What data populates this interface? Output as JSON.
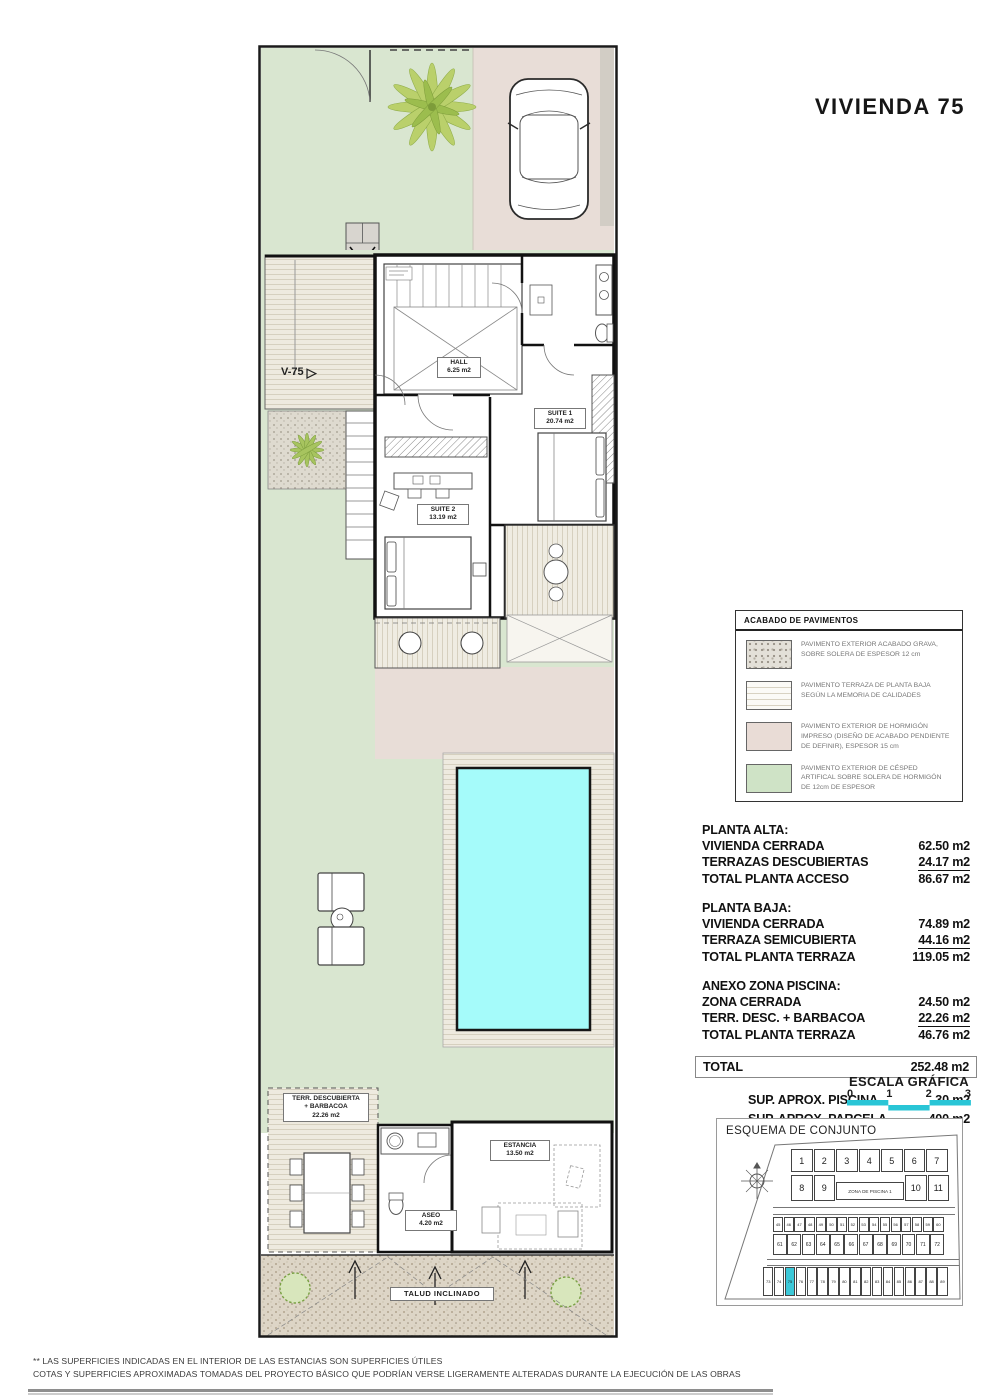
{
  "title": "VIVIENDA 75",
  "colors": {
    "lawn": "#d9e6d0",
    "driveway_concrete": "#e8ddd7",
    "pool_water": "#a5fbfa",
    "deck": "#eeeadf",
    "scale_bar_cyan": "#29c5d6",
    "highlight_unit_cyan": "#3cc8d8"
  },
  "plan": {
    "entry_label": "V-75",
    "labels": {
      "hall": {
        "name": "HALL",
        "area": "6.25 m2"
      },
      "suite1": {
        "name": "SUITE 1",
        "area": "20.74 m2"
      },
      "suite2": {
        "name": "SUITE 2",
        "area": "13.19 m2"
      },
      "estancia": {
        "name": "ESTANCIA",
        "area": "13.50 m2"
      },
      "aseo": {
        "name": "ASEO",
        "area": "4.20 m2"
      },
      "terraza": {
        "name": "TERR. DESCUBIERTA",
        "name2": "+ BARBACOA",
        "area": "22.26 m2"
      },
      "talud": {
        "name": "TALUD INCLINADO"
      }
    }
  },
  "legend": {
    "title": "ACABADO DE PAVIMENTOS",
    "items": [
      {
        "swatch": "gravel",
        "text": "PAVIMENTO EXTERIOR ACABADO GRAVA, SOBRE SOLERA DE ESPESOR 12 cm"
      },
      {
        "swatch": "terrace",
        "text": "PAVIMENTO TERRAZA DE PLANTA BAJA SEGÚN LA MEMORIA DE CALIDADES"
      },
      {
        "swatch": "concrete",
        "text": "PAVIMENTO EXTERIOR DE HORMIGÓN IMPRESO (DISEÑO DE ACABADO PENDIENTE DE DEFINIR), ESPESOR 15 cm"
      },
      {
        "swatch": "grass",
        "text": "PAVIMENTO EXTERIOR DE CÉSPED ARTIFICAL SOBRE SOLERA DE HORMIGÓN DE 12cm DE ESPESOR"
      }
    ]
  },
  "areas": {
    "s1": {
      "header": "PLANTA ALTA:",
      "rows": [
        {
          "label": "VIVIENDA CERRADA",
          "value": "62.50 m2"
        },
        {
          "label": "TERRAZAS DESCUBIERTAS",
          "value": "24.17 m2",
          "u": true
        },
        {
          "label": "TOTAL PLANTA ACCESO",
          "value": "86.67 m2"
        }
      ]
    },
    "s2": {
      "header": "PLANTA BAJA:",
      "rows": [
        {
          "label": "VIVIENDA CERRADA",
          "value": "74.89 m2"
        },
        {
          "label": "TERRAZA SEMICUBIERTA",
          "value": "44.16 m2",
          "u": true
        },
        {
          "label": "TOTAL PLANTA TERRAZA",
          "value": "119.05 m2"
        }
      ]
    },
    "s3": {
      "header": "ANEXO ZONA PISCINA:",
      "rows": [
        {
          "label": "ZONA CERRADA",
          "value": "24.50 m2"
        },
        {
          "label": "TERR. DESC. + BARBACOA",
          "value": "22.26 m2",
          "u": true
        },
        {
          "label": "TOTAL PLANTA TERRAZA",
          "value": "46.76 m2"
        }
      ]
    },
    "total": {
      "label": "TOTAL",
      "value": "252.48 m2"
    },
    "extras": [
      {
        "label": "SUP.  APROX.  PISCINA",
        "value": "30 m2"
      },
      {
        "label": "SUP.  APROX.  PARCELA",
        "value": "400 m2"
      }
    ]
  },
  "scale": {
    "title": "ESCALA GRÁFICA",
    "ticks": [
      "0",
      "1",
      "2",
      "3"
    ]
  },
  "esquema": {
    "title": "ESQUEMA DE CONJUNTO",
    "zona_label": "ZONA DE PISCINA 1",
    "row1": [
      "1",
      "2",
      "3",
      "4",
      "5",
      "6",
      "7"
    ],
    "row2a": [
      "8",
      "9"
    ],
    "row2b": [
      "10",
      "11"
    ],
    "row3": [
      "45",
      "46",
      "47",
      "48",
      "49",
      "50",
      "51",
      "52",
      "53",
      "54",
      "55",
      "56",
      "57",
      "58",
      "59",
      "60"
    ],
    "row4": [
      "61",
      "62",
      "63",
      "64",
      "65",
      "66",
      "67",
      "68",
      "69",
      "70",
      "71",
      "72"
    ],
    "row5": [
      "73",
      "74",
      "75",
      "76",
      "77",
      "78",
      "79",
      "80",
      "81",
      "82",
      "83",
      "84",
      "85",
      "86",
      "87",
      "88",
      "89"
    ],
    "highlight": "75"
  },
  "footnote": {
    "line1": "** LAS SUPERFICIES INDICADAS EN EL INTERIOR DE LAS ESTANCIAS SON SUPERFICIES ÚTILES",
    "line2": "COTAS Y SUPERFICIES APROXIMADAS TOMADAS DEL PROYECTO BÁSICO QUE PODRÍAN VERSE LIGERAMENTE ALTERADAS DURANTE LA EJECUCIÓN DE LAS OBRAS"
  }
}
